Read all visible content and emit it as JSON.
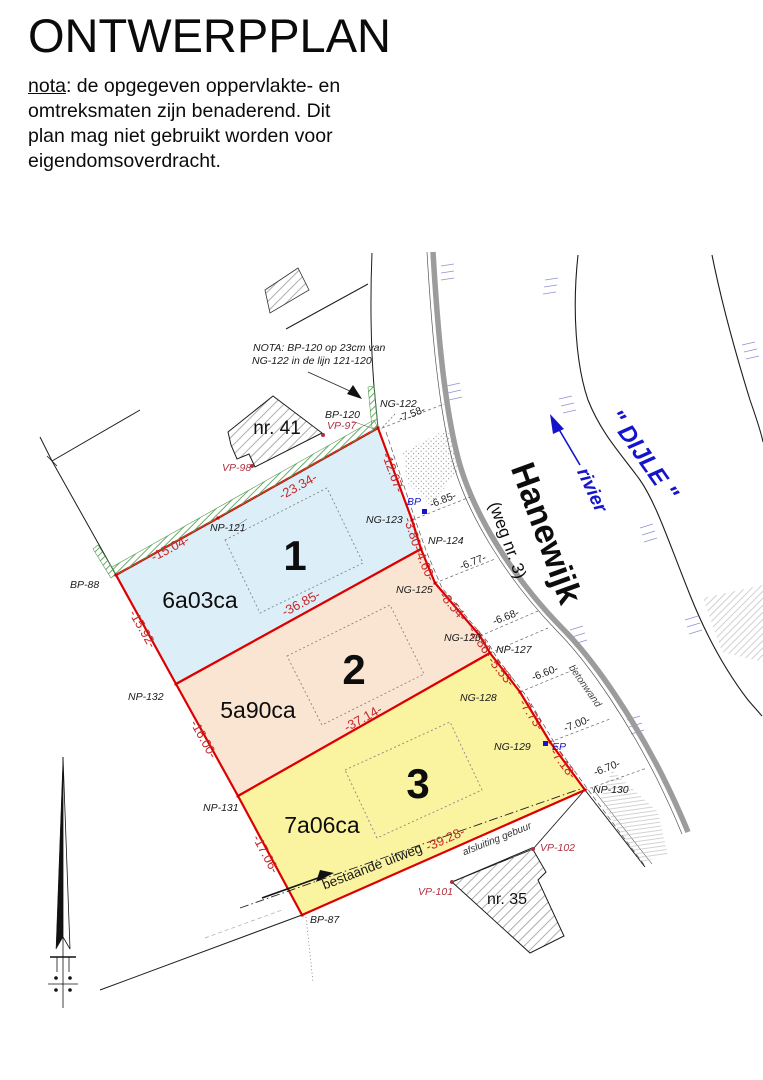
{
  "header": {
    "title": "ONTWERPPLAN",
    "nota_label": "nota",
    "nota_rest": ": de opgegeven oppervlakte- en",
    "nota_line2": "omtreksmaten zijn benaderend. Dit",
    "nota_line3": "plan mag niet gebruikt worden voor",
    "nota_line4": "eigendomsoverdracht."
  },
  "plan": {
    "note_line1": "NOTA: BP-120 op 23cm van",
    "note_line2": "NG-122 in de lijn 121-120",
    "parcels": [
      {
        "number": "1",
        "area": "6a03ca"
      },
      {
        "number": "2",
        "area": "5a90ca"
      },
      {
        "number": "3",
        "area": "7a06ca"
      }
    ],
    "buildings": {
      "b41": "nr. 41",
      "b35": "nr. 35"
    },
    "road": {
      "name": "Hanewijk",
      "number": "(weg nr. 3)",
      "wall": "betonwand"
    },
    "river": {
      "name": "\" DIJLE \"",
      "label": "rivier"
    },
    "notes": {
      "exit": "bestaande uitweg",
      "fence": "afsluiting gebuur"
    },
    "red_measurements": {
      "m1504": "-15.04-",
      "m2334": "-23.34-",
      "m1267": "-12.67-",
      "m380": "-3.80-",
      "m460": "-4.60-",
      "m854": "-8.54-",
      "m286": "-2.86-",
      "m553": "-5.53-",
      "m773": "-7.73-",
      "m718": "-7.18-",
      "m1592": "-15.92-",
      "m1600": "-16.00-",
      "m1706": "-17.06-",
      "m3685": "-36.85-",
      "m3714": "-37.14-",
      "m3928": "-39.28-"
    },
    "black_measurements": {
      "m758": "-7.58-",
      "m685": "-6.85-",
      "m677": "-6.77-",
      "m668": "-6.68-",
      "m660": "-6.60-",
      "m700": "-7.00-",
      "m670": "-6.70-"
    },
    "points": {
      "bp120": "BP-120",
      "ng122": "NG-122",
      "vp97": "VP-97",
      "vp98": "VP-98",
      "np121": "NP-121",
      "bp88": "BP-88",
      "ng123": "NG-123",
      "bp": "BP",
      "np124": "NP-124",
      "ng125": "NG-125",
      "ng126": "NG-126",
      "np127": "NP-127",
      "ng128": "NG-128",
      "ng129": "NG-129",
      "ep": "EP",
      "np130": "NP-130",
      "np132": "NP-132",
      "np131": "NP-131",
      "bp87": "BP-87",
      "vp101": "VP-101",
      "vp102": "VP-102"
    }
  },
  "colors": {
    "parcel1": "#dceef7",
    "parcel2": "#fae5d3",
    "parcel3": "#faf3a0",
    "boundary_red": "#dd0000",
    "measure_red": "#c62828",
    "vp_red": "#b03040",
    "blue": "#1414cc",
    "green": "#4d9e4d",
    "road_gray": "#9c9c9c"
  }
}
